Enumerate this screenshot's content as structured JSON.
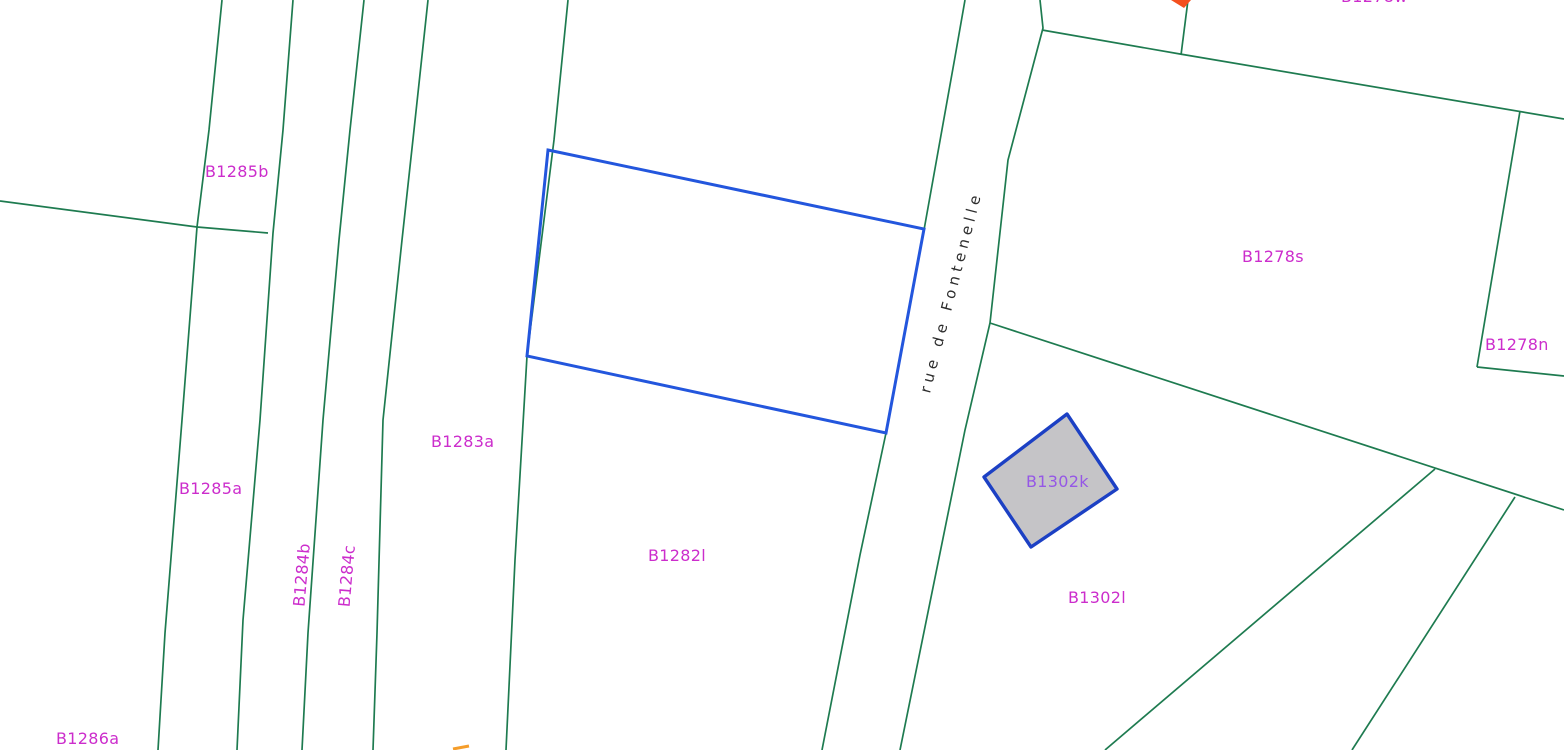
{
  "map": {
    "street_label": "rue de Fontenelle",
    "parcel_labels": {
      "b1285b": "B1285b",
      "b1285a": "B1285a",
      "b1284b": "B1284b",
      "b1284c": "B1284c",
      "b1283a": "B1283a",
      "b1282l": "B1282l",
      "b1286a": "B1286a",
      "b1278s": "B1278s",
      "b1278n": "B1278n",
      "b1278w": "B1278w",
      "b1302k": "B1302k",
      "b1302l": "B1302l"
    },
    "colors": {
      "boundary_green": "#1e7b50",
      "selection_blue": "#2356dd",
      "building_outline_blue": "#1c40c4",
      "building_fill_gray": "#c5c4c7",
      "label_magenta": "#cc2dcc",
      "building_label_violet": "#9557e6",
      "street_text": "#2e2e2e",
      "marker_orange_red": "#f4501e",
      "marker_amber": "#f59d2a"
    }
  }
}
